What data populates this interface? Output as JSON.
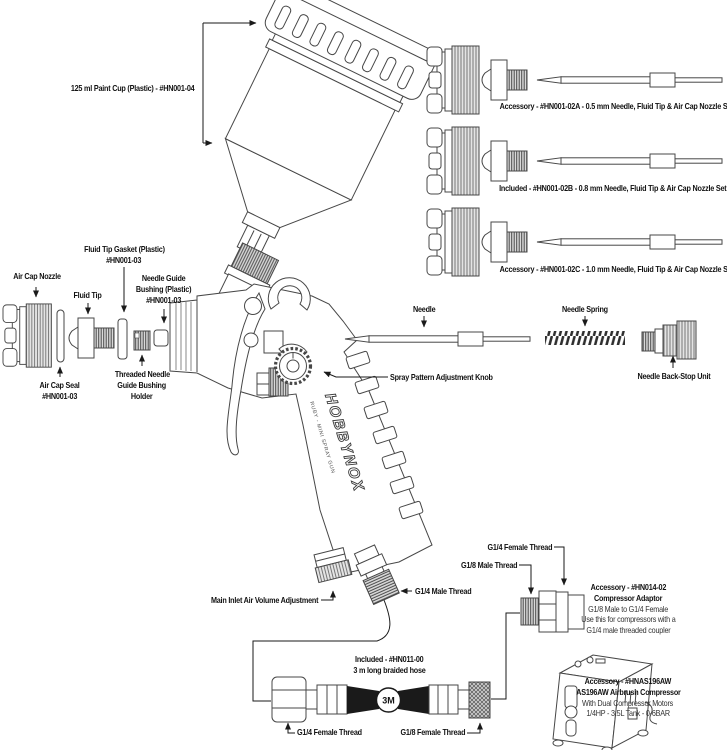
{
  "figure": {
    "paint_cup": "125 ml Paint Cup (Plastic) - #HN001-04",
    "nozzle_sets": {
      "a": "Accessory - #HN001-02A - 0.5 mm Needle, Fluid Tip & Air Cap Nozzle Set",
      "b": "Included - #HN001-02B - 0.8 mm Needle, Fluid Tip & Air Cap Nozzle Set",
      "c": "Accessory - #HN001-02C - 1.0 mm Needle, Fluid Tip & Air Cap Nozzle Set"
    },
    "front_parts": {
      "air_cap_nozzle": "Air Cap Nozzle",
      "fluid_tip_gasket": [
        "Fluid Tip Gasket (Plastic)",
        "#HN001-03"
      ],
      "fluid_tip": "Fluid Tip",
      "needle_guide_bushing": [
        "Needle Guide",
        "Bushing (Plastic)",
        "#HN001-03"
      ],
      "air_cap_seal": [
        "Air Cap Seal",
        "#HN001-03"
      ],
      "bushing_holder": [
        "Threaded Needle",
        "Guide Bushing",
        "Holder"
      ]
    },
    "mid_parts": {
      "needle": "Needle",
      "needle_spring": "Needle Spring",
      "needle_back_stop": "Needle Back-Stop Unit",
      "spray_pattern_knob": "Spray Pattern Adjustment Knob"
    },
    "gun": {
      "logo": "HOBBYNOX",
      "model": "RUBY - MINI SPRAY GUN",
      "main_inlet": "Main Inlet Air Volume Adjustment",
      "g14_male": "G1/4 Male Thread"
    },
    "adaptor": {
      "g14_female": "G1/4 Female Thread",
      "g18_male": "G1/8 Male Thread",
      "lines": [
        "Accessory - #HN014-02",
        "Compressor Adaptor",
        "G1/8 Male to G1/4 Female",
        "Use this for compressors with a",
        "G1/4 male threaded coupler"
      ]
    },
    "hose": {
      "lines": [
        "Included - #HN011-00",
        "3 m long braided hose"
      ],
      "g14_female": "G1/4 Female Thread",
      "g18_female": "G1/8 Female Thread",
      "badge": "3M"
    },
    "compressor": {
      "lines": [
        "Accessory - #HNAS196AW",
        "AS196AW Airbrush Compressor",
        "With Dual Compressor Motors",
        "1/4HP - 3.5L Tank - 0-6BAR"
      ]
    }
  },
  "colors": {
    "ink": "#1a1a1a",
    "line": "#474747"
  }
}
